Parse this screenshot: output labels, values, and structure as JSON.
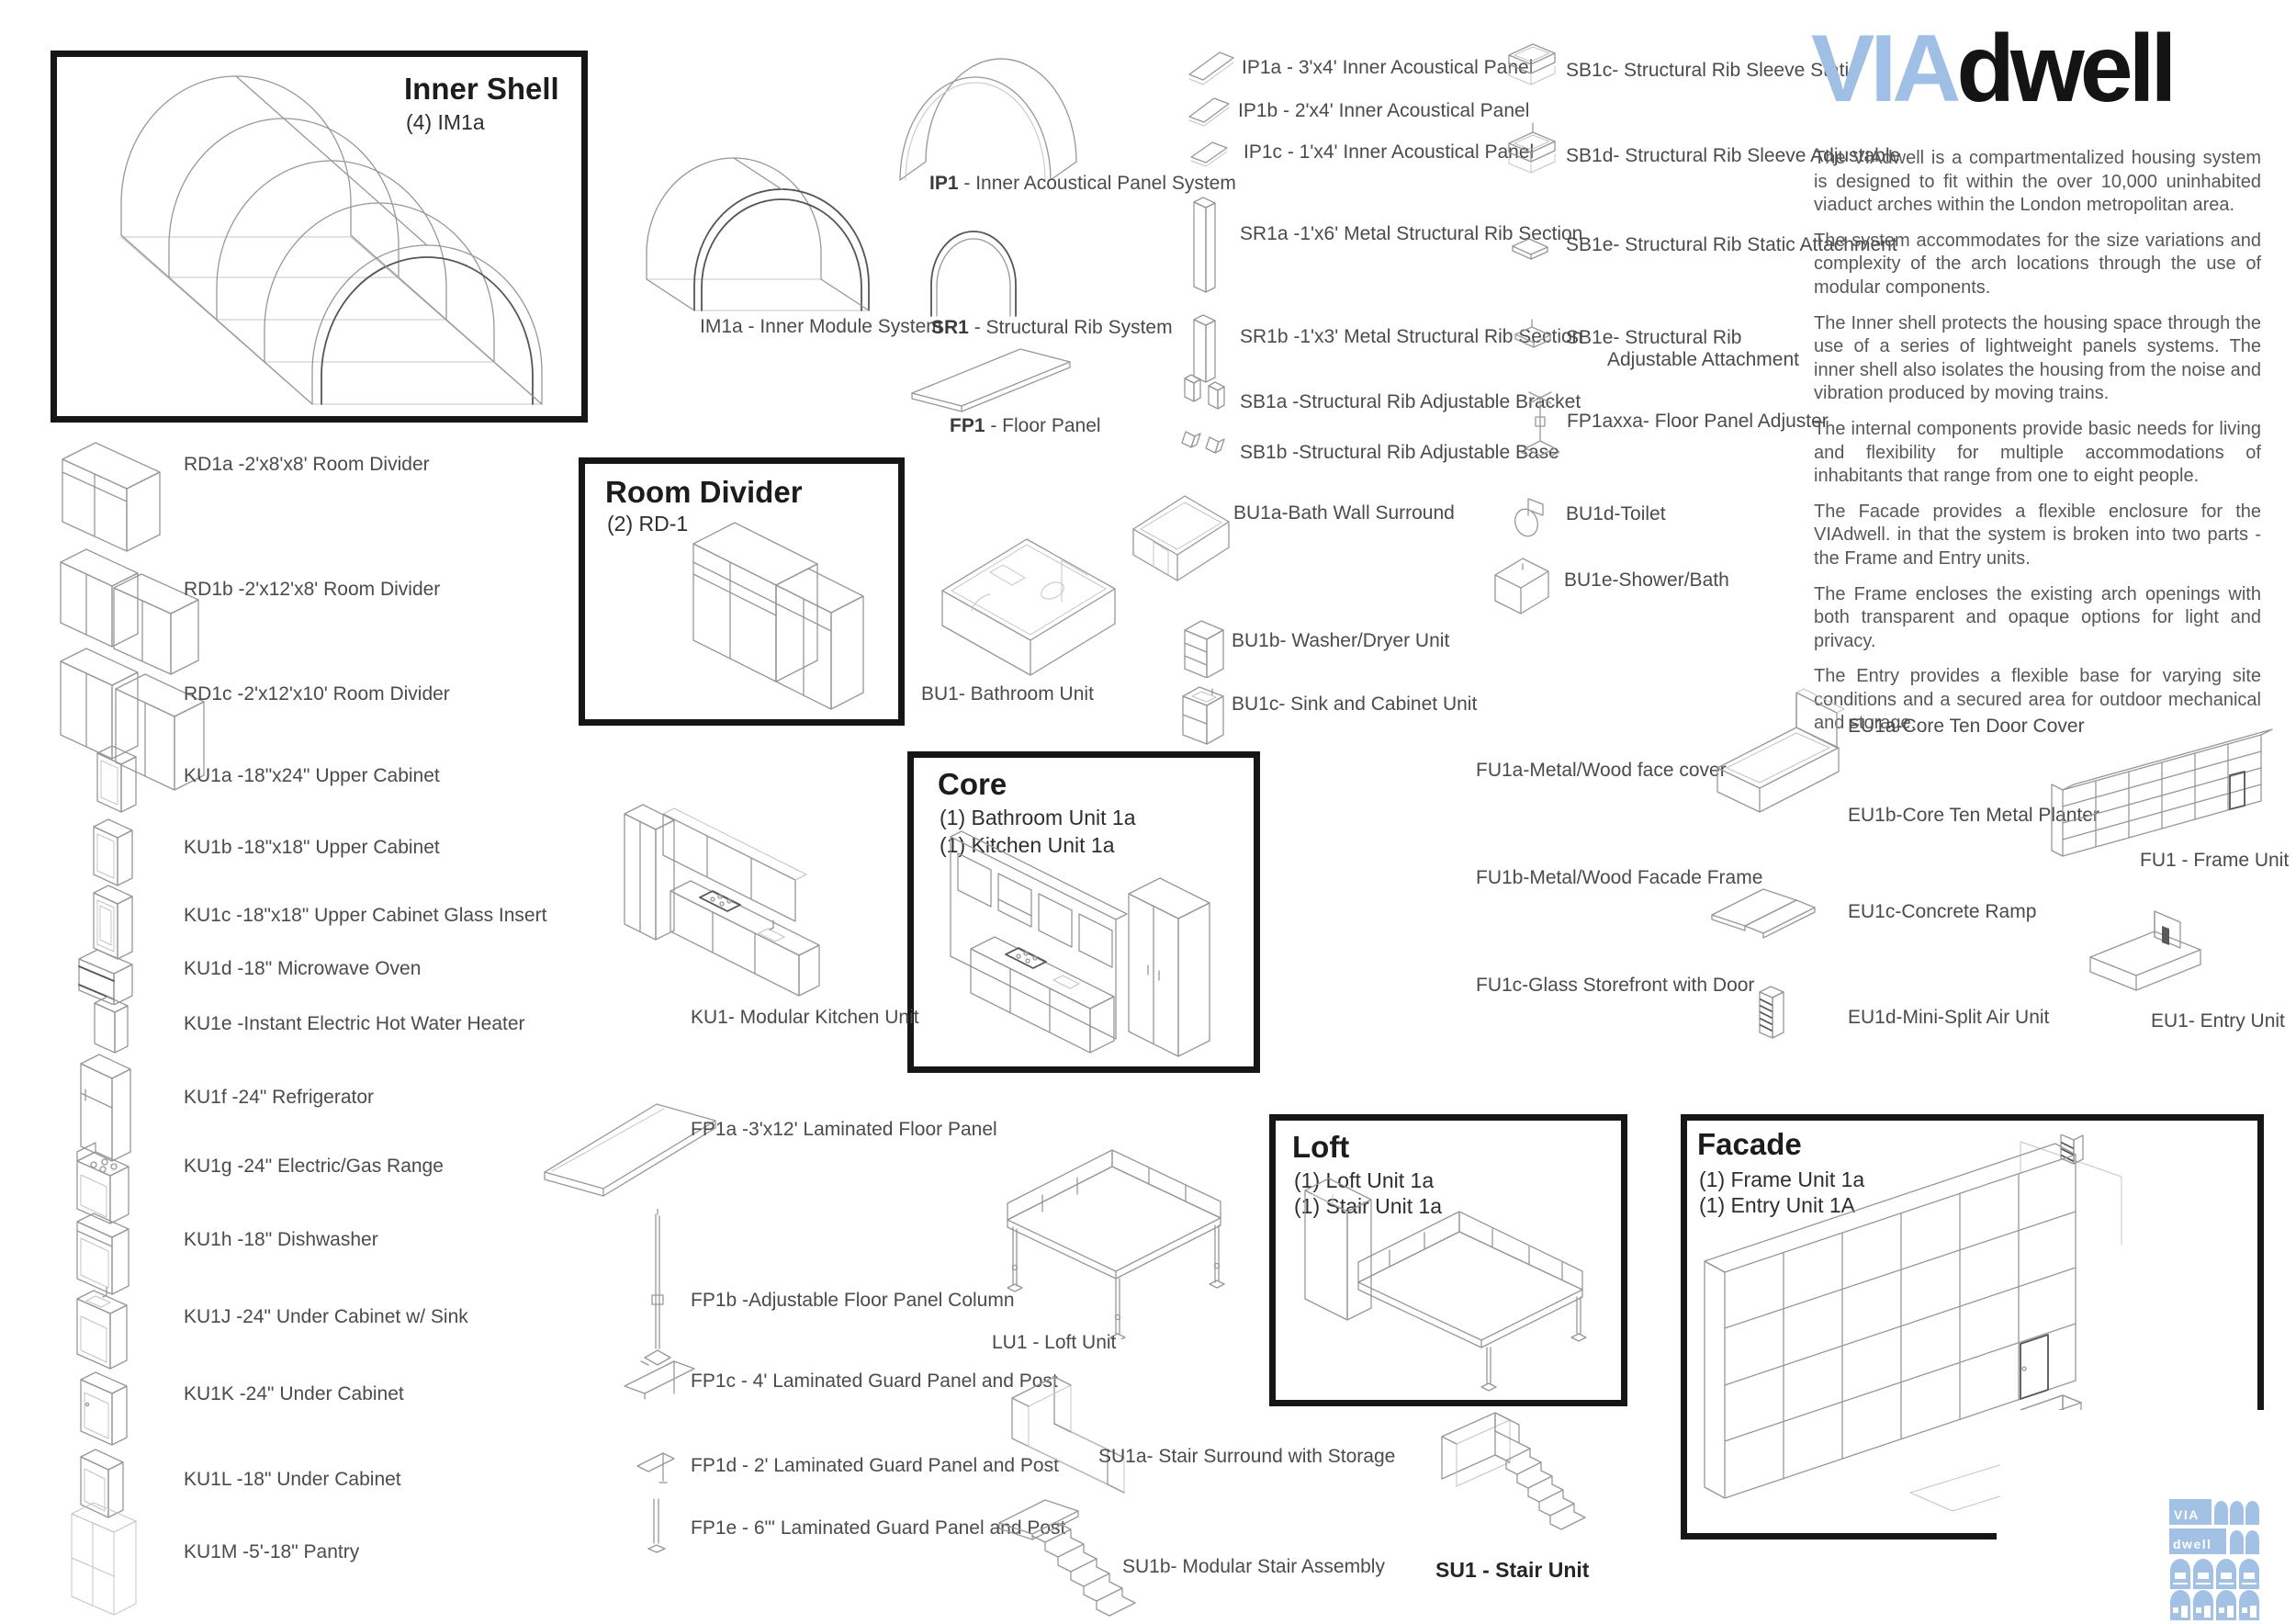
{
  "brand": {
    "via": "VIA",
    "dwell": "dwell"
  },
  "stamp": {
    "line1": "VIA",
    "line2": "dwell"
  },
  "intro_paragraphs": [
    "The VIAdwell is a compartmentalized housing system is designed to fit within the over 10,000 uninhabited viaduct arches within the London metropolitan area.",
    "The system accommodates for the size variations and complexity of the arch locations through the use of modular components.",
    "The Inner shell protects the housing space through the use of a series of lightweight panels systems.  The inner shell also isolates the housing from the noise and vibration produced by moving trains.",
    "The internal components provide basic needs for living and flexibility for multiple accommodations of inhabitants that range from one to eight people.",
    "The Facade provides a flexible enclosure for the VIAdwell. in that the system is broken into two parts - the Frame and Entry units.",
    "The Frame encloses the existing arch openings with both transparent and opaque options for light and privacy.",
    "The Entry provides a flexible base for varying site conditions and a secured area for outdoor mechanical and storage."
  ],
  "boxes": {
    "inner_shell": {
      "title": "Inner Shell",
      "subtitle": "(4) IM1a"
    },
    "room_divider": {
      "title": "Room Divider",
      "subtitle": "(2) RD-1"
    },
    "core": {
      "title": "Core",
      "line1": "(1) Bathroom Unit 1a",
      "line2": "(1) Kitchen Unit 1a"
    },
    "loft": {
      "title": "Loft",
      "line1": "(1) Loft Unit 1a",
      "line2": "(1) Stair Unit 1a"
    },
    "facade": {
      "title": "Facade",
      "line1": "(1) Frame Unit 1a",
      "line2": "(1) Entry Unit 1A"
    }
  },
  "systems": {
    "im1a": "IM1a - Inner Module System",
    "ip1_b": "IP1",
    "ip1_t": " - Inner Acoustical Panel System",
    "sr1_b": "SR1",
    "sr1_t": " - Structural Rib System",
    "fp1_b": "FP1",
    "fp1_t": " - Floor Panel"
  },
  "col1": [
    "IP1a - 3'x4' Inner Acoustical Panel",
    "IP1b - 2'x4' Inner Acoustical Panel",
    "IP1c - 1'x4' Inner Acoustical Panel",
    "SR1a -1'x6' Metal Structural Rib Section",
    "SR1b -1'x3' Metal Structural Rib Section",
    "SB1a -Structural Rib Adjustable Bracket",
    "SB1b -Structural Rib Adjustable Base",
    "BU1a-Bath Wall Surround",
    "BU1b- Washer/Dryer Unit",
    "BU1c- Sink and Cabinet Unit"
  ],
  "col2": [
    "SB1c- Structural Rib Sleeve Static",
    "SB1d- Structural Rib Sleeve Adjustable",
    "SB1e- Structural Rib Static Attachment",
    "SB1e- Structural Rib",
    "Adjustable Attachment",
    "FP1axxa- Floor Panel Adjuster",
    "BU1d-Toilet",
    "BU1e-Shower/Bath"
  ],
  "left_list": [
    "RD1a -2'x8'x8' Room Divider",
    "RD1b -2'x12'x8' Room Divider",
    "RD1c -2'x12'x10' Room Divider",
    "KU1a -18\"x24\" Upper Cabinet",
    "KU1b -18\"x18\" Upper Cabinet",
    "KU1c -18\"x18\" Upper Cabinet Glass Insert",
    "KU1d -18\" Microwave Oven",
    "KU1e -Instant Electric Hot Water Heater",
    "KU1f -24\" Refrigerator",
    "KU1g -24\" Electric/Gas Range",
    "KU1h -18\" Dishwasher",
    "KU1J -24\" Under Cabinet w/ Sink",
    "KU1K -24\" Under Cabinet",
    "KU1L -18\" Under Cabinet",
    "KU1M -5'-18\" Pantry"
  ],
  "fp_list": [
    "FP1a -3'x12' Laminated Floor Panel",
    "FP1b -Adjustable Floor Panel Column",
    "FP1c - 4' Laminated Guard Panel and Post",
    "FP1d - 2' Laminated Guard Panel and Post",
    "FP1e - 6\"' Laminated Guard Panel and Post"
  ],
  "units": {
    "bu1": "BU1- Bathroom Unit",
    "ku1": "KU1- Modular Kitchen Unit",
    "lu1": "LU1 - Loft Unit",
    "su1a": "SU1a- Stair Surround with Storage",
    "su1b": "SU1b- Modular Stair Assembly",
    "su1": "SU1 - Stair Unit",
    "fu1": "FU1 - Frame Unit",
    "eu1": "EU1- Entry Unit"
  },
  "fu_list": [
    "FU1a-Metal/Wood face cover",
    "FU1b-Metal/Wood Facade Frame",
    "FU1c-Glass Storefront with Door"
  ],
  "eu_list": [
    "EU1a-Core Ten Door Cover",
    "EU1b-Core Ten Metal Planter",
    "EU1c-Concrete Ramp",
    "EU1d-Mini-Split Air Unit"
  ],
  "colors": {
    "accent_blue": "#a2c1e4",
    "ink": "#1c1c1c",
    "label": "#4b4b4b",
    "paragraph": "#57585a"
  }
}
